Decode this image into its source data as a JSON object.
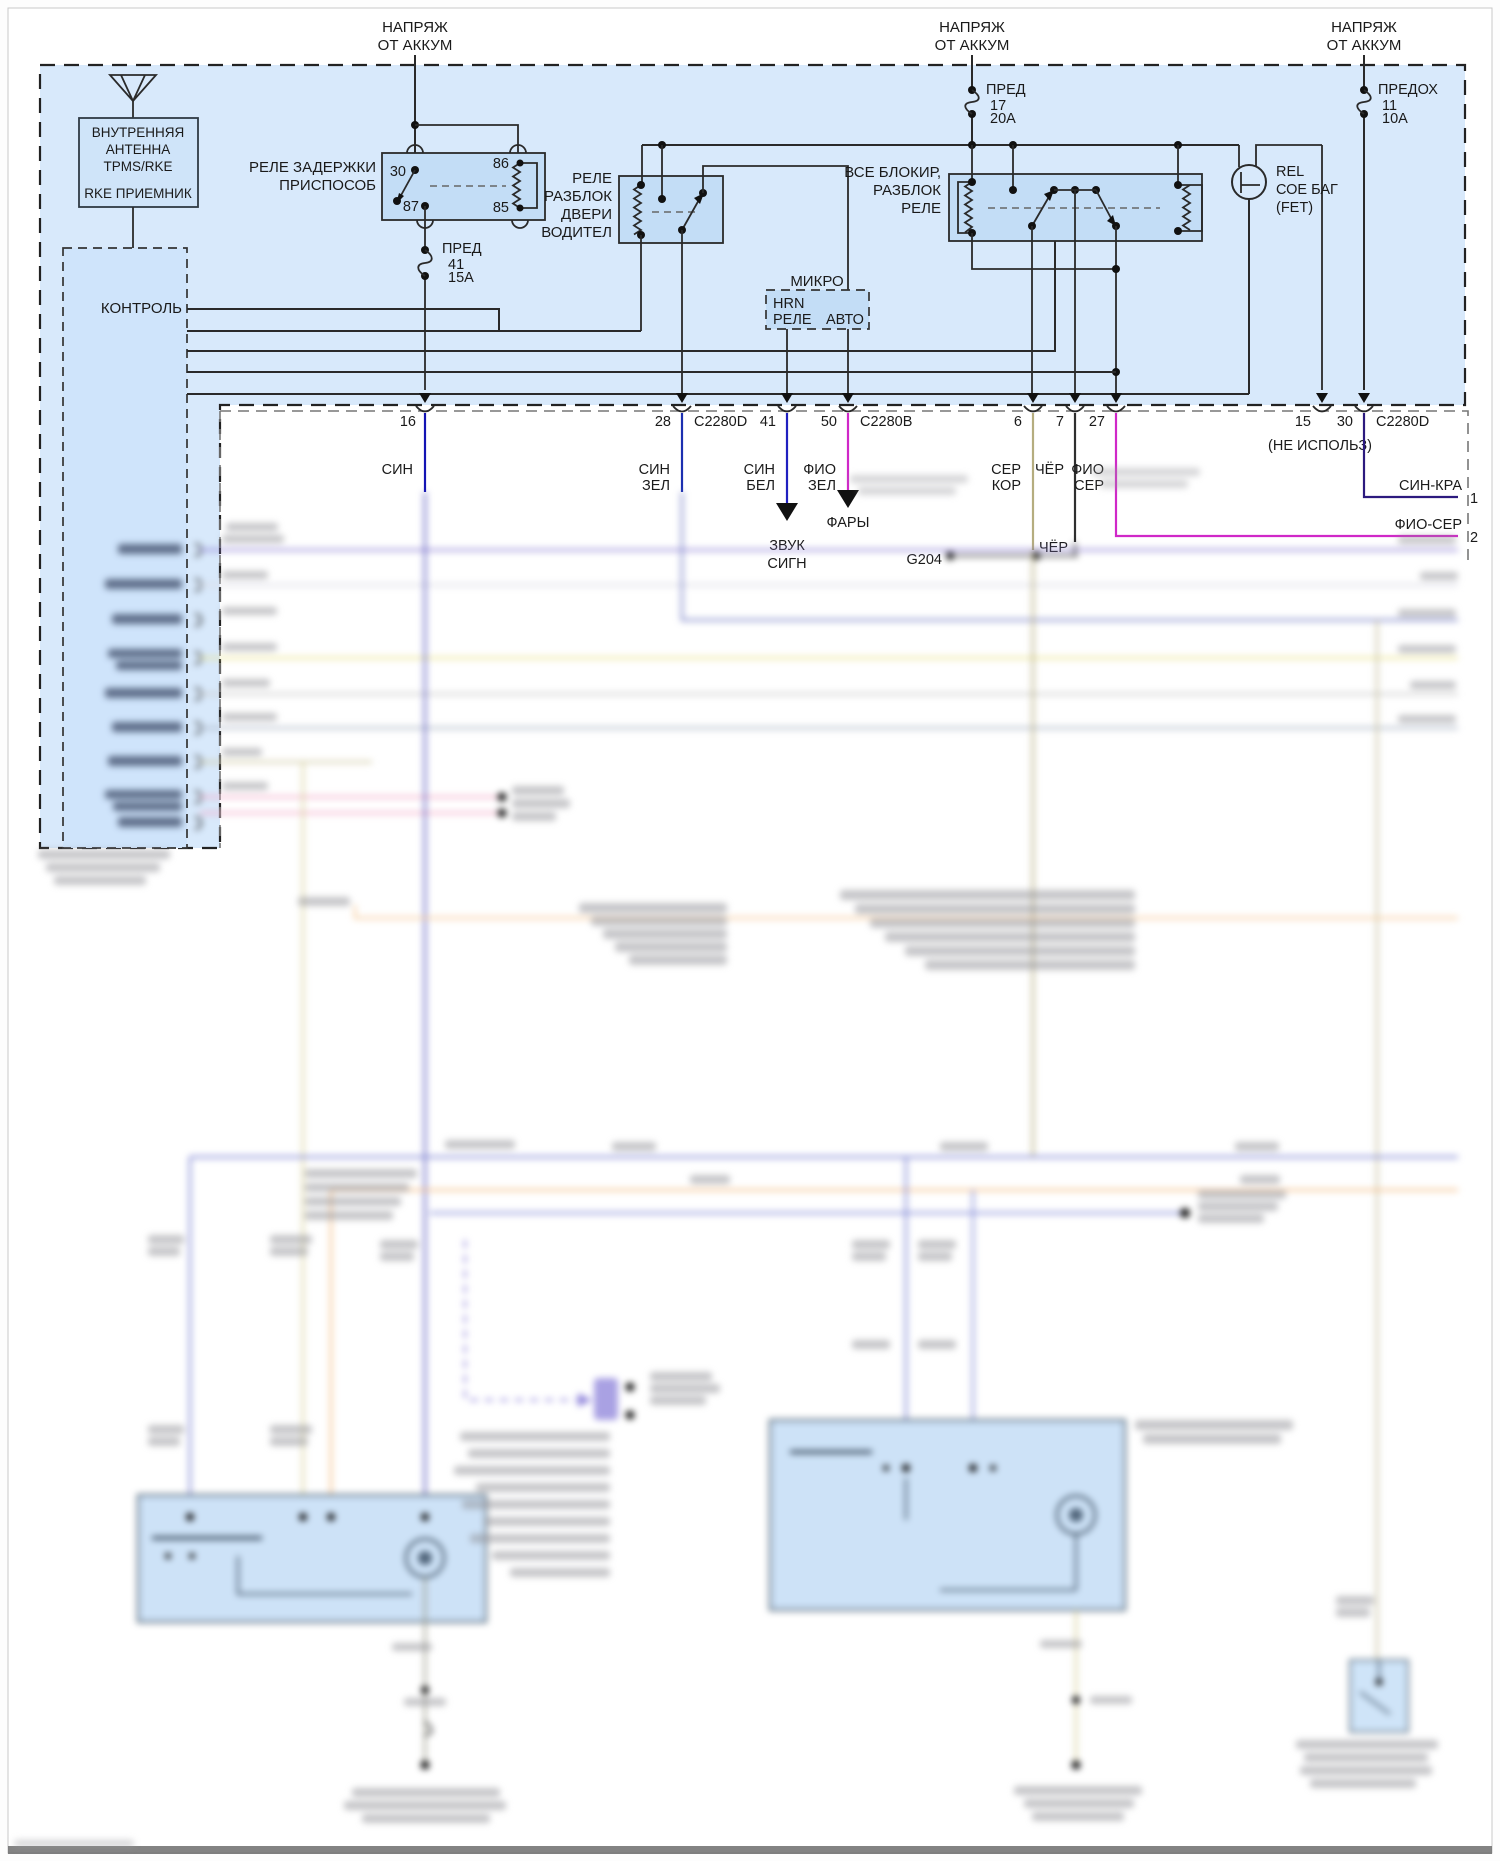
{
  "d": {
    "feed": {
      "l1": "НАПРЯЖ",
      "l2": "ОТ АККУМ"
    },
    "rx": {
      "l1": "ВНУТРЕННЯЯ",
      "l2": "АНТЕННА",
      "l3": "TPMS/RKE",
      "l4": "RKE ПРИЕМНИК"
    },
    "control": "КОНТРОЛЬ",
    "r1": {
      "l1": "РЕЛЕ ЗАДЕРЖКИ",
      "l2": "ПРИСПОСОБ",
      "p30": "30",
      "p86": "86",
      "p87": "87",
      "p85": "85"
    },
    "f41": {
      "l1": "ПРЕД",
      "l2": "41",
      "l3": "15А"
    },
    "f17": {
      "l1": "ПРЕД",
      "l2": "17",
      "l3": "20А"
    },
    "f11": {
      "l1": "ПРЕДОХ",
      "l2": "11",
      "l3": "10А"
    },
    "r2": {
      "l1": "РЕЛЕ",
      "l2": "РАЗБЛОК",
      "l3": "ДВЕРИ",
      "l4": "ВОДИТЕЛ"
    },
    "r3": {
      "l1": "ВСЕ БЛОКИР,",
      "l2": "РАЗБЛОК",
      "l3": "РЕЛЕ"
    },
    "micro": {
      "title": "МИКРО",
      "l1": "HRN",
      "l2": "РЕЛЕ",
      "l3": "АВТО"
    },
    "fet": {
      "l1": "REL",
      "l2": "СОЕ БАГ",
      "l3": "(FET)"
    },
    "pins": {
      "p16": "16",
      "p28": "28",
      "c28": "C2280D",
      "p41": "41",
      "p50": "50",
      "c50": "C2280B",
      "p6": "6",
      "p7": "7",
      "p27": "27",
      "p15": "15",
      "p30": "30",
      "c30": "C2280D",
      "nu": "(НЕ ИСПОЛЬЗ)"
    },
    "w": {
      "sin": "СИН",
      "sinzel1": "СИН",
      "sinzel2": "ЗЕЛ",
      "sinbel1": "СИН",
      "sinbel2": "БЕЛ",
      "fiozel1": "ФИО",
      "fiozel2": "ЗЕЛ",
      "serkor1": "СЕР",
      "serkor2": "КОР",
      "cher": "ЧЁР",
      "fioser1": "ФИО",
      "fioser2": "СЕР",
      "sinkra": "СИН-КРА",
      "fioser": "ФИО-СЕР",
      "n1": "1",
      "n2": "2"
    },
    "out": {
      "horn1": "ЗВУК",
      "horn2": "СИГН",
      "lamps": "ФАРЫ",
      "cher": "ЧЁР",
      "g204": "G204"
    }
  },
  "colors": {
    "module_bg": "#d8e9fb",
    "relay_bg": "#c3ddf6",
    "white_module": "#ffffff",
    "wire_sin": "#1414b4",
    "wire_sinzel": "#1c2fb0",
    "wire_sinbel": "#2020c0",
    "wire_magenta": "#d028c8",
    "wire_tan": "#b5ad7f",
    "wire_black": "#2f2f2f",
    "wire_sinkra": "#2c1a7e"
  }
}
